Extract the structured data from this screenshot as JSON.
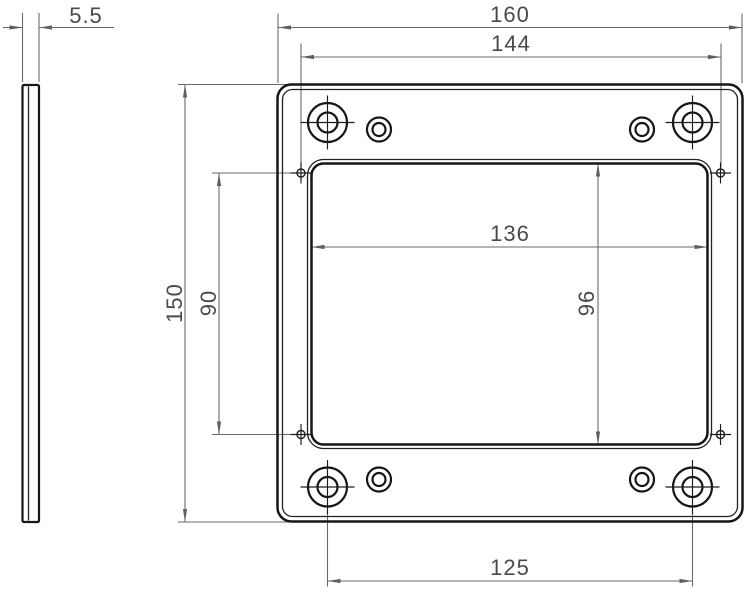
{
  "dimensions": {
    "thickness": "5.5",
    "overall_width": "160",
    "hole_grid_width": "144",
    "window_width": "136",
    "overall_height": "150",
    "pilot_grid_height": "90",
    "window_height": "96",
    "bottom_hole_spacing": "125"
  },
  "colors": {
    "outline": "#161616",
    "dimension_line": "#6a6a6a",
    "dimension_text": "#4a4a4a",
    "background": "#ffffff"
  }
}
